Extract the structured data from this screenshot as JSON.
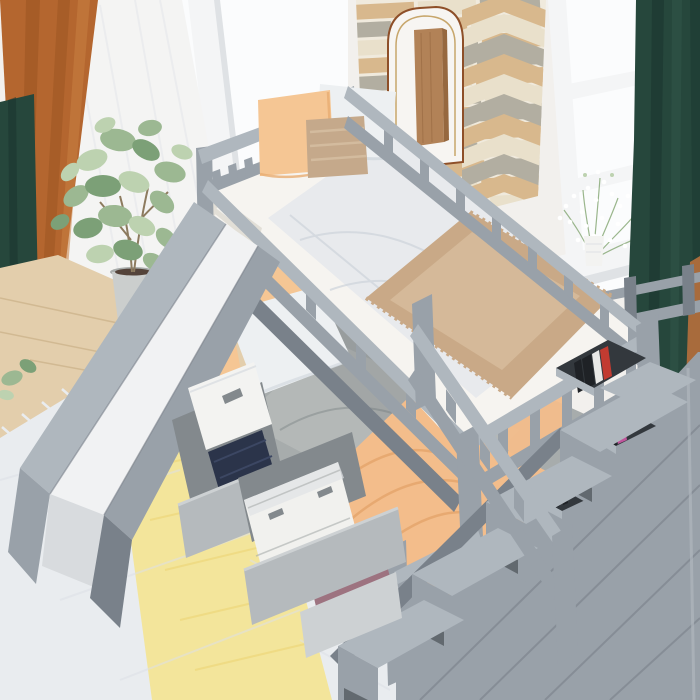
{
  "meta": {
    "kind": "product-photo",
    "canvas": {
      "width": 700,
      "height": 700
    },
    "description": "Gray twin-over-full bunk bed with a slide, a storage staircase with book cubbies, and two pulled-out under-bed storage drawers, staged in a bright bedroom with two windows, green and rust curtains, a stone accent wall with an arched panel, a fiddle-leaf fig plant, a light wood floor and a white-and-yellow striped rug."
  },
  "scene": {
    "room": {
      "left_window": {
        "label": "window with white sheer curtain"
      },
      "right_window": {
        "label": "window with baby's breath flowers in a white vase on the sill"
      },
      "curtains": [
        {
          "label": "dark green curtain, far left"
        },
        {
          "label": "rust orange curtain, left"
        },
        {
          "label": "white sheer curtain, left window"
        },
        {
          "label": "dark green curtain, right"
        }
      ],
      "accent_wall": {
        "label": "tan and gray stone accent wall with herringbone column and white arched panel with center wood plank"
      },
      "floor": {
        "label": "light oak plank floor"
      },
      "rug": {
        "label": "white rug with wide yellow stripe and fringe"
      },
      "plant": {
        "label": "potted fiddle-leaf fig"
      }
    },
    "furniture": {
      "frame": {
        "label": "gray wood twin-over-full bunk bed frame"
      },
      "top_bunk": {
        "label": "twin loft bed",
        "bedding": [
          "white mattress with ticking edge",
          "white flat sheet",
          "tan faux-fur throw blanket"
        ],
        "pillows": [
          "peach square pillow",
          "white square pillow",
          "woven tan accent pillow"
        ]
      },
      "bottom_bunk": {
        "label": "full-size lower bed",
        "bedding": [
          "gray duvet",
          "peach throw blanket across the middle"
        ],
        "pillows": [
          "white pillow",
          "peach pillow"
        ]
      },
      "slide": {
        "label": "gray slide with white sliding surface, left side"
      },
      "staircase": {
        "label": "gray storage staircase with four steps, guard rail and open cubbies",
        "books": [
          "dark book spines",
          "red book",
          "white book",
          "pink book"
        ]
      },
      "underbed_storage": {
        "label": "two pulled-out under-bed storage drawers",
        "contents": [
          "white lidded box",
          "navy folded clothes",
          "white storage basket",
          "mauve folded bag with black strap"
        ]
      }
    }
  },
  "palette": {
    "wall_white": "#F2F0ED",
    "wall_lit": "#F7F5F2",
    "window_glass": "#FBFCFD",
    "window_frame": "#F4F5F6",
    "frame_edge": "#DFE2E5",
    "sheer": "#F3F3F2",
    "curtain_orange": "#B4662F",
    "curtain_orange_dark": "#94501F",
    "curtain_orange_light": "#C97F42",
    "curtain_green": "#26473C",
    "curtain_green_dark": "#17322B",
    "curtain_green_light": "#31584A",
    "stone_tan": "#D8B88D",
    "stone_gray": "#B2AEA1",
    "stone_cream": "#E9E0CB",
    "stone_mortar": "#F0EADD",
    "arch_white": "#F7F5F2",
    "arch_trim_brown": "#8E4F28",
    "arch_trim_gold": "#C7A66B",
    "plank_wood": "#B28257",
    "plank_wood_dark": "#96683F",
    "floor_wood": "#E3CEAC",
    "floor_wood_light": "#F0E2C2",
    "floor_line": "#C3A87E",
    "rug_white": "#E9ECEF",
    "rug_gray": "#DCE0E5",
    "rug_yellow": "#F3E59B",
    "rug_yellow_deep": "#EDD87E",
    "bed_gray": "#99A1A9",
    "bed_gray_light": "#AFB7BE",
    "bed_gray_dark": "#79818A",
    "bed_gray_darker": "#62696F",
    "slide_surface": "#F1F2F3",
    "slide_shadow": "#D8DBDE",
    "mattress": "#F6F4F0",
    "ticking": "#E2DFD7",
    "duvet": "#E8EAED",
    "duvet_shadow": "#CDD3DA",
    "tan_blanket": "#C9A987",
    "tan_blanket_light": "#DEC6A8",
    "orange_pillow": "#F5C694",
    "orange_deep": "#E8AC72",
    "white_pillow": "#EDF0F2",
    "white_pillow_shadow": "#D6DCE1",
    "tan_pillow": "#C5A98B",
    "tan_pillow_light": "#D6BFA3",
    "gray_duvet": "#A7ACAC",
    "gray_duvet_light": "#B9BDBC",
    "gray_duvet_dark": "#8F9596",
    "orange_blanket": "#F3BD8B",
    "orange_blanket_dark": "#E3A368",
    "bin_gray": "#B5BABD",
    "bin_gray_light": "#CDD1D3",
    "bin_interior": "#83898D",
    "box_white": "#F3F3F1",
    "navy": "#2B344A",
    "navy_light": "#3C4763",
    "mauve": "#9D7380",
    "mauve_dark": "#815D6A",
    "strap_black": "#26262A",
    "basket_white": "#F1F1EE",
    "plant_green": "#9CB892",
    "plant_green_dark": "#7CA077",
    "plant_green_light": "#BDD2B0",
    "trunk_brown": "#8D7B5F",
    "pot_gray": "#CBCECD",
    "pot_dark": "#A9ADAC",
    "soil": "#54433A",
    "cubby_dark": "#33383D",
    "book_red": "#C23B31",
    "book_white": "#E9E9E7",
    "book_pink": "#C0549B",
    "book_dark": "#1F2226",
    "wood_brown_right": "#A86B3C",
    "stem_green": "#8FAE7F",
    "flower_white": "#FFFFFF"
  }
}
